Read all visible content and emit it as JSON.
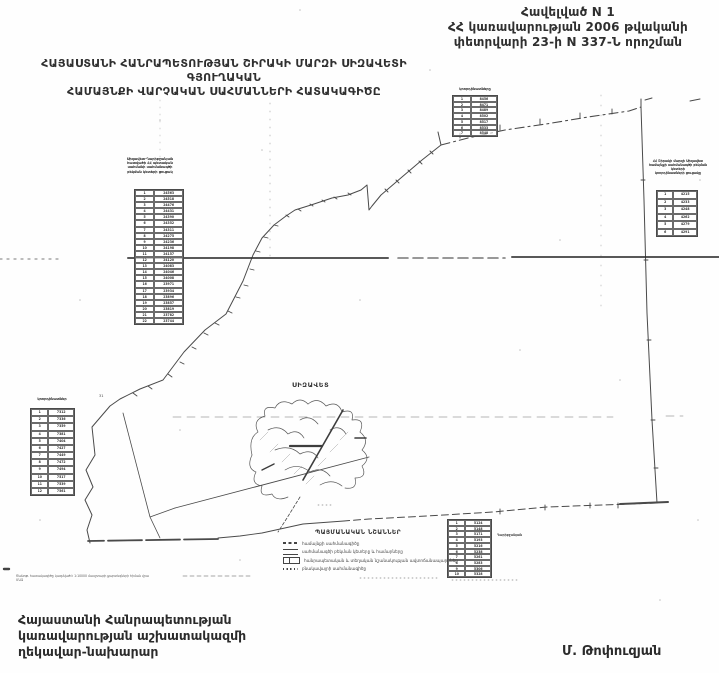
{
  "document": {
    "appendix": {
      "line1": "Հավելված N 1",
      "line2": "ՀՀ կառավարության 2006 թվականի",
      "line3": "փետրվարի 23-ի N 337-Ն որոշման"
    },
    "title": {
      "line1": "ՀԱՅԱՍՏԱՆԻ ՀԱՆՐԱՊԵՏՈՒԹՅԱՆ ՇԻՐԱԿԻ ՄԱՐԶԻ ՍԻԶԱՎԵՏԻ ԳՅՈՒՂԱԿԱՆ",
      "line2": "ՀԱՄԱՅՆՔԻ ՎԱՐՉԱԿԱՆ ՍԱՀՄԱՆՆԵՐԻ ՀԱՏԱԿԱԳԻԾԸ"
    },
    "footer": {
      "line1": "Հայաստանի Հանրապետության",
      "line2": "կառավարության աշխատակազմի",
      "line3": "ղեկավար-նախարար",
      "signature": "Մ. Թոփուզյան"
    },
    "note": {
      "line1": "Ծանոթ․ հատակագիծը կազմված է 1:10000 մասշտաբի քարտեզների հիման վրա",
      "line2": "ՄԱԶ"
    }
  },
  "map": {
    "settlement_label": "ՍԻԶԱՎԵՏ",
    "corner_number": "31",
    "ink_color": "#4a4a4a",
    "artifact_color": "#2e2e2e"
  },
  "legend": {
    "title": "ՊԱՅՄԱՆԱԿԱՆ ՆՇԱՆՆԵՐ",
    "items": [
      {
        "symbol": "dash-line-symbol",
        "label": "համայնքի սահմանագիծը"
      },
      {
        "symbol": "double-line-symbol",
        "label": "սահմանագծի բեկման կետերը և համարները"
      },
      {
        "symbol": "road-box-symbol",
        "label": "հանրապետական և տեղական նշանակության ավտոճանապարհներ"
      },
      {
        "symbol": "dotted-line-symbol",
        "label": "բնակավայրի սահմանագիծը"
      }
    ]
  },
  "tables": {
    "left": {
      "header_lines": [
        "Սիզավետ-Ղարիբջանյան",
        "հատվածի ՀՀ պետական",
        "սահմանի սահմանագծի",
        "բեկման կետերի ցուցակ"
      ],
      "rows": [
        [
          "1",
          "24563"
        ],
        [
          "2",
          "24518"
        ],
        [
          "3",
          "24476"
        ],
        [
          "4",
          "24431"
        ],
        [
          "5",
          "24390"
        ],
        [
          "6",
          "24352"
        ],
        [
          "7",
          "24311"
        ],
        [
          "8",
          "24275"
        ],
        [
          "9",
          "24236"
        ],
        [
          "10",
          "24198"
        ],
        [
          "11",
          "24157"
        ],
        [
          "12",
          "24120"
        ],
        [
          "13",
          "24083"
        ],
        [
          "14",
          "24046"
        ],
        [
          "15",
          "24008"
        ],
        [
          "16",
          "23971"
        ],
        [
          "17",
          "23934"
        ],
        [
          "18",
          "23896"
        ],
        [
          "19",
          "23857"
        ],
        [
          "20",
          "23819"
        ],
        [
          "21",
          "23782"
        ],
        [
          "22",
          "23744"
        ]
      ]
    },
    "top": {
      "header_lines": [
        "կոորդինատները"
      ],
      "rows": [
        [
          "1",
          "8456"
        ],
        [
          "2",
          "8471"
        ],
        [
          "3",
          "8489"
        ],
        [
          "4",
          "8502"
        ],
        [
          "5",
          "8517"
        ],
        [
          "6",
          "8533"
        ],
        [
          "7",
          "8548"
        ]
      ]
    },
    "right": {
      "header_lines": [
        "ՀՀ Շիրակի մարզի Սիզավետ",
        "համայնքի սահմանագծի բեկման",
        "կետերի",
        "կոորդինատների ցուցակը"
      ],
      "rows": [
        [
          "1",
          "4215"
        ],
        [
          "2",
          "4233"
        ],
        [
          "3",
          "4248"
        ],
        [
          "4",
          "4262"
        ],
        [
          "5",
          "4279"
        ],
        [
          "6",
          "4291"
        ]
      ]
    },
    "left_lower": {
      "header_lines": [
        "կոորդինատներ"
      ],
      "rows": [
        [
          "1",
          "7312"
        ],
        [
          "2",
          "7336"
        ],
        [
          "3",
          "7359"
        ],
        [
          "4",
          "7381"
        ],
        [
          "5",
          "7404"
        ],
        [
          "6",
          "7427"
        ],
        [
          "7",
          "7449"
        ],
        [
          "8",
          "7472"
        ],
        [
          "9",
          "7494"
        ],
        [
          "10",
          "7517"
        ],
        [
          "11",
          "7539"
        ],
        [
          "12",
          "7561"
        ]
      ]
    },
    "bottom": {
      "side_label": "Ղարիբջանյան",
      "rows": [
        [
          "1",
          "5124"
        ],
        [
          "2",
          "5148"
        ],
        [
          "3",
          "5171"
        ],
        [
          "4",
          "5193"
        ],
        [
          "5",
          "5216"
        ],
        [
          "6",
          "5238"
        ],
        [
          "7",
          "5261"
        ],
        [
          "8",
          "5283"
        ],
        [
          "9",
          "5306"
        ],
        [
          "10",
          "5328"
        ]
      ]
    }
  }
}
